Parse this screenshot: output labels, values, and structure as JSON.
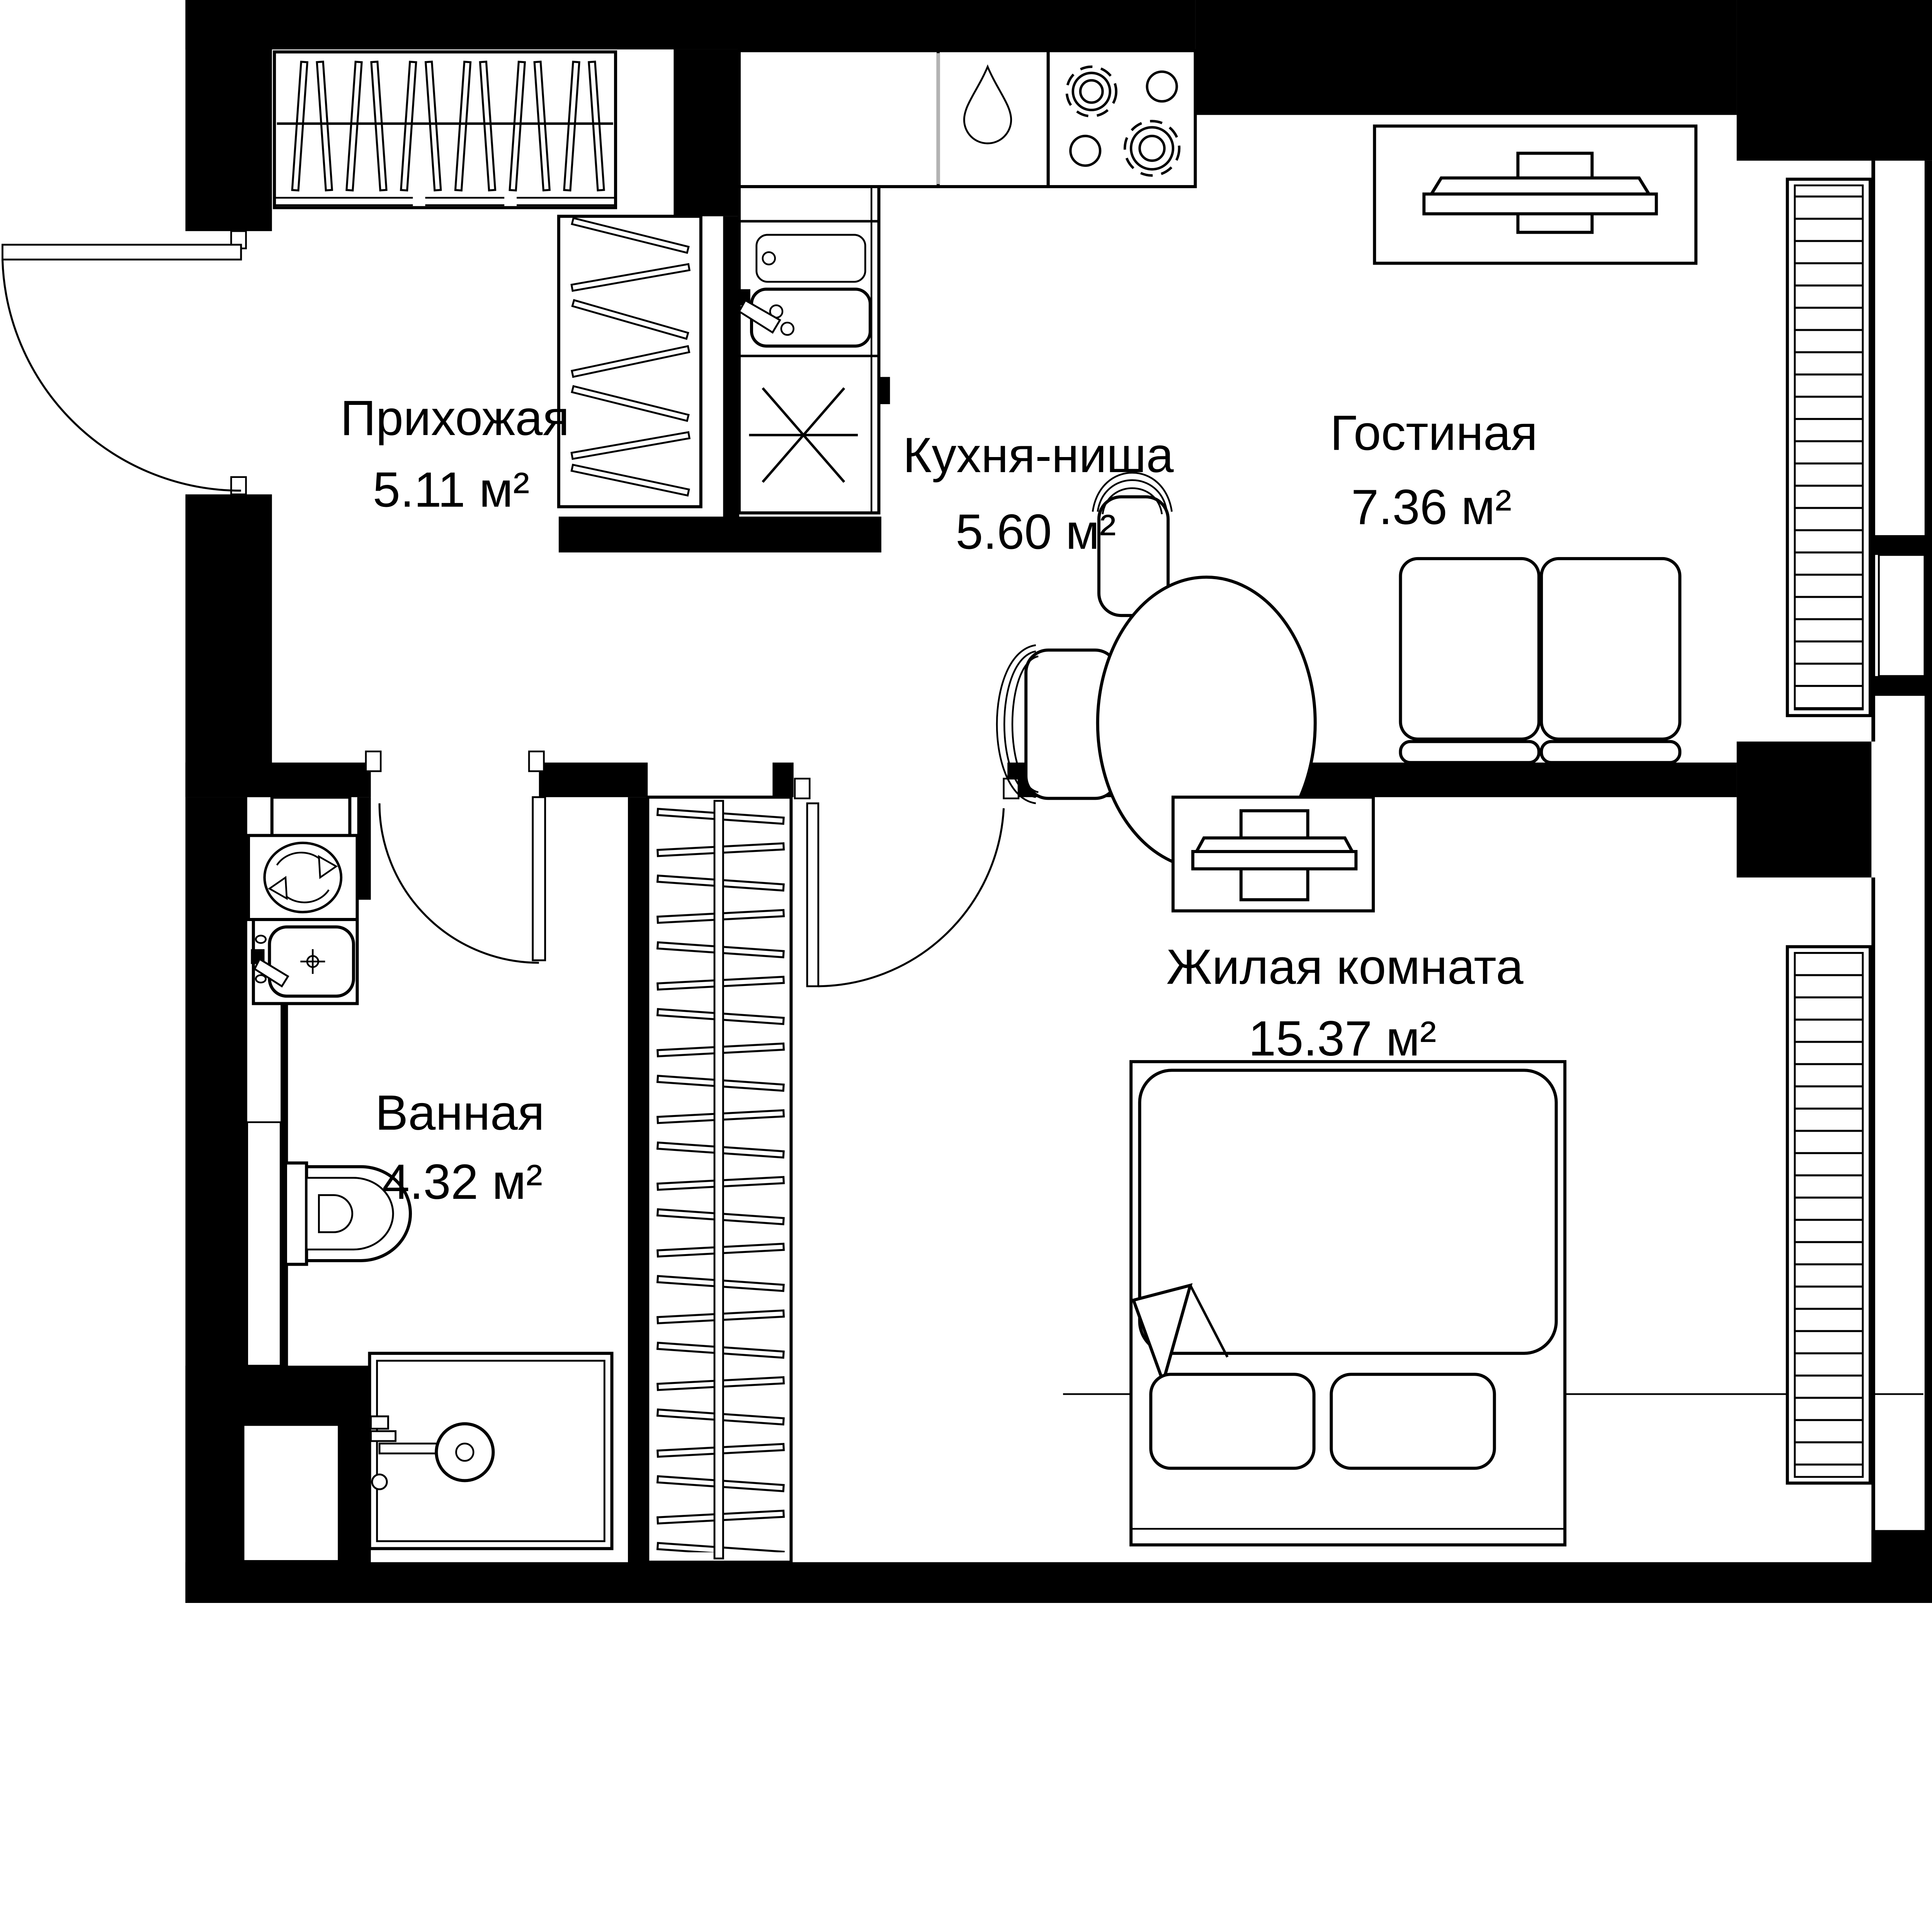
{
  "rooms": [
    {
      "id": "hallway",
      "name": "Прихожая",
      "area": "5.11 м²"
    },
    {
      "id": "kitchen",
      "name": "Кухня-ниша",
      "area": "5.60 м²"
    },
    {
      "id": "living",
      "name": "Гостиная",
      "area": "7.36 м²"
    },
    {
      "id": "bathroom",
      "name": "Ванная",
      "area": "4.32 м²"
    },
    {
      "id": "bedroom",
      "name": "Жилая комната",
      "area": "15.37 м²"
    }
  ],
  "colors": {
    "wall": "#000000",
    "background": "#ffffff",
    "counter_divider": "#b3b3b3",
    "text": "#000000"
  },
  "icons": [
    "entrance-door-icon",
    "interior-door-icon",
    "hanger-wardrobe-icon",
    "sliding-wardrobe-icon",
    "kitchen-counter-icon",
    "water-drop-icon",
    "cooktop-icon",
    "kitchen-sink-icon",
    "vent-asterisk-icon",
    "tv-console-icon",
    "sofa-icon",
    "round-table-icon",
    "chair-icon",
    "radiator-icon",
    "washing-machine-icon",
    "bathroom-sink-icon",
    "toilet-icon",
    "shower-icon",
    "double-bed-icon",
    "pillow-icon"
  ]
}
